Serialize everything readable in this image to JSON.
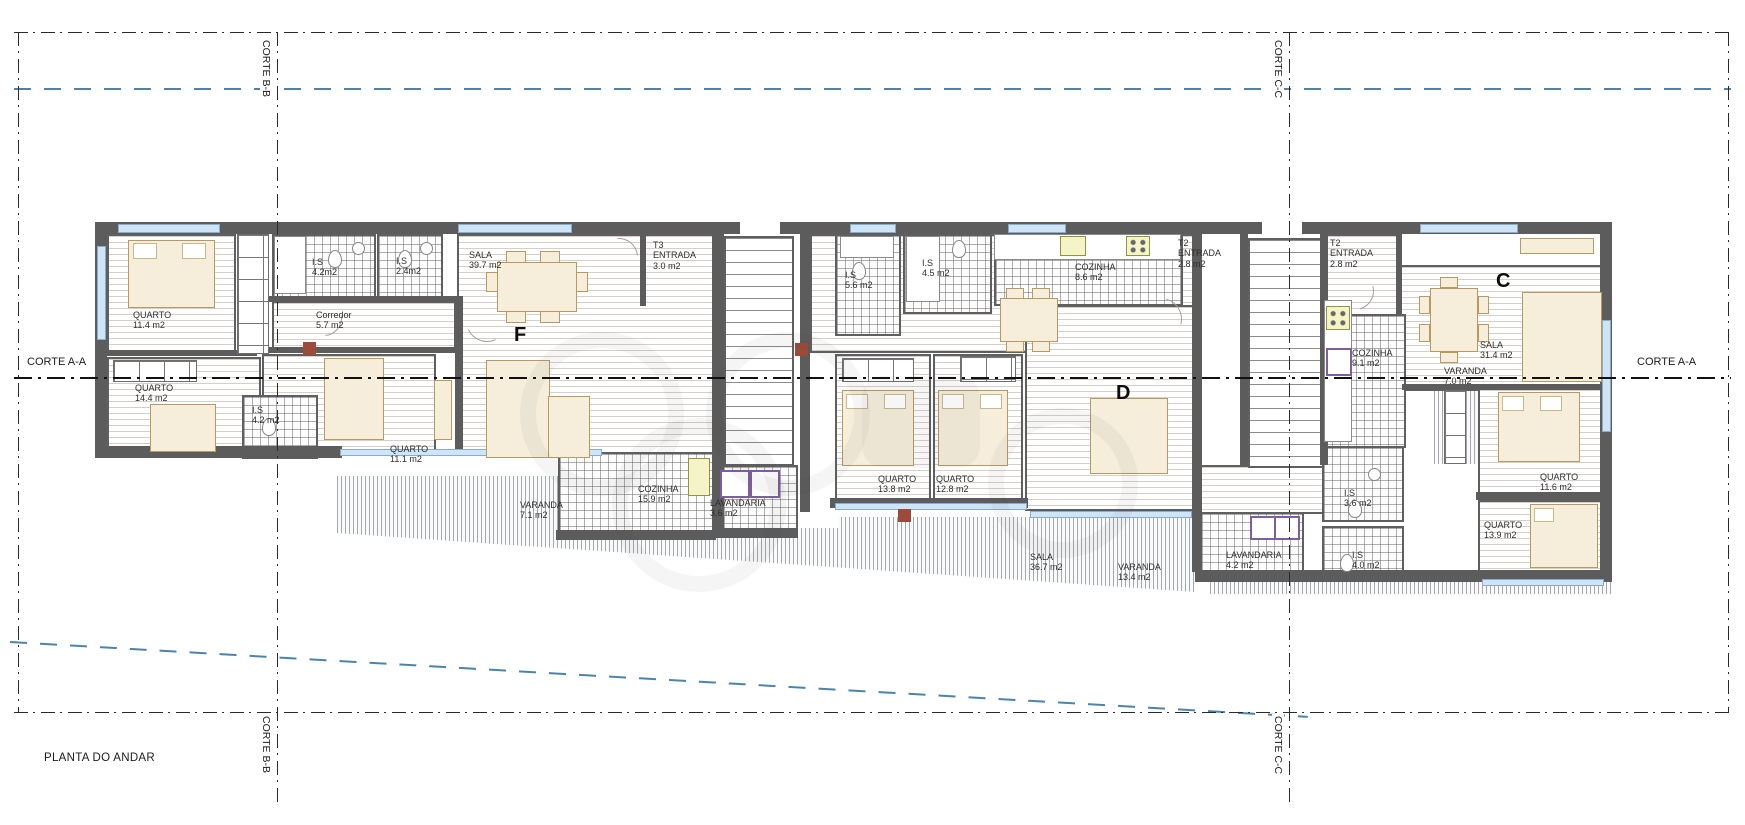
{
  "meta": {
    "title": "PLANTA DO ANDAR"
  },
  "sections": {
    "aa_left": "CORTE A-A",
    "aa_right": "CORTE A-A",
    "bb_top": "CORTE B-B",
    "bb_bottom": "CORTE B-B",
    "cc_top": "CORTE C-C",
    "cc_bottom": "CORTE C-C"
  },
  "units": [
    {
      "label": "F",
      "rooms": [
        {
          "name": "QUARTO",
          "area": "11.4 m2"
        },
        {
          "name": "I.S",
          "area": "4.2m2"
        },
        {
          "name": "I.S",
          "area": "2.4m2"
        },
        {
          "name": "Corredor",
          "area": "5.7 m2"
        },
        {
          "name": "QUARTO",
          "area": "14.4 m2"
        },
        {
          "name": "I.S",
          "area": "4.2 m2"
        },
        {
          "name": "QUARTO",
          "area": "11.1 m2"
        },
        {
          "name": "SALA",
          "area": "39.7 m2"
        },
        {
          "prefix": "T3",
          "name": "ENTRADA",
          "area": "3.0 m2"
        },
        {
          "name": "COZINHA",
          "area": "15.9 m2"
        },
        {
          "name": "VARANDA",
          "area": "7.1 m2"
        },
        {
          "name": "LAVANDARIA",
          "area": "3.6 m2"
        }
      ]
    },
    {
      "label": "D",
      "rooms": [
        {
          "name": "I.S",
          "area": "5.6 m2"
        },
        {
          "name": "I.S",
          "area": "4.5 m2"
        },
        {
          "name": "COZINHA",
          "area": "8.6 m2"
        },
        {
          "prefix": "T2",
          "name": "ENTRADA",
          "area": "2.8 m2"
        },
        {
          "name": "QUARTO",
          "area": "13.8 m2"
        },
        {
          "name": "QUARTO",
          "area": "12.8 m2"
        },
        {
          "name": "SALA",
          "area": "36.7 m2"
        },
        {
          "name": "VARANDA",
          "area": "13.4 m2"
        }
      ]
    },
    {
      "label": "C",
      "rooms": [
        {
          "prefix": "T2",
          "name": "ENTRADA",
          "area": "2.8 m2"
        },
        {
          "name": "COZINHA",
          "area": "9.1 m2"
        },
        {
          "name": "SALA",
          "area": "31.4 m2"
        },
        {
          "name": "VARANDA",
          "area": "7.0 m2"
        },
        {
          "name": "QUARTO",
          "area": "11.6 m2"
        },
        {
          "name": "QUARTO",
          "area": "13.9 m2"
        },
        {
          "name": "I.S",
          "area": "3.6 m2"
        },
        {
          "name": "I.S",
          "area": "4.0 m2"
        },
        {
          "name": "LAVANDARIA",
          "area": "4.2 m2"
        }
      ]
    }
  ],
  "colors": {
    "wall": "#5c5c5c",
    "cut_line": "#1a1a1a",
    "section_line_blue": "#4a84ad",
    "window": "#cfe4f4",
    "furniture": "#f6eedb",
    "appliance_yellow": "#f5f3c8",
    "washer_border": "#7d5fa0",
    "accent_red": "#9c4a39"
  }
}
